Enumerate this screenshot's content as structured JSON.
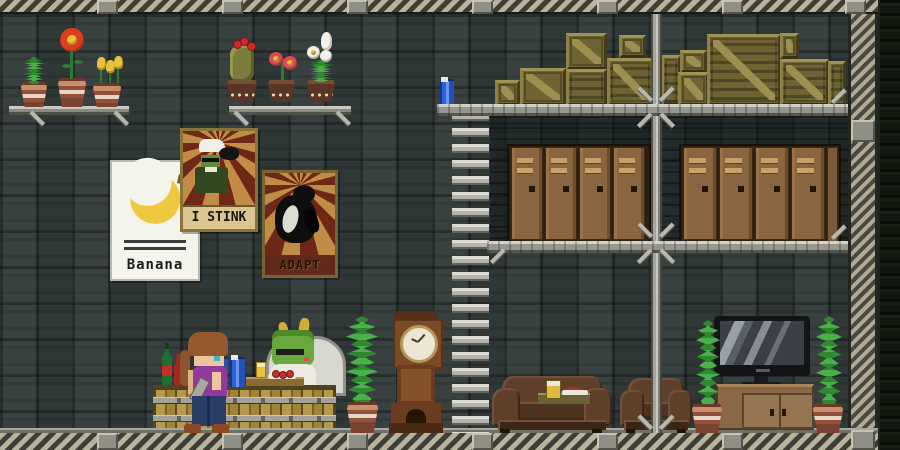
{
  "window": {
    "width": 900,
    "height": 450,
    "title": "Pixel-art station interior with bar, storage lockers and cargo crates"
  },
  "posters": {
    "banana": {
      "label": "Banana"
    },
    "stink": {
      "label": "I STINK"
    },
    "adapt": {
      "label": "ADAPT"
    }
  },
  "palette": {
    "wall": "#323a3a",
    "hazard_light": "#b7b39d",
    "hazard_dark": "#3f3e35",
    "platform_gray": "#97978f",
    "crate_khaki": "#6e6433",
    "locker_brown": "#8a6540",
    "couch_brown": "#5d3d28",
    "plant_green": "#3fa03f",
    "pot_terracotta": "#b5704f",
    "counter_wood": "#b59a4e",
    "canister_blue": "#2e62d8",
    "poster_ray_red": "#6f2816",
    "poster_ray_tan": "#c08c46"
  },
  "objects": {
    "ceiling_plates_x": [
      97,
      222,
      347,
      472,
      597,
      722,
      845
    ],
    "floor_plates_x": [
      97,
      222,
      347,
      472,
      597,
      722
    ],
    "brackets": [
      [
        28,
        116,
        45
      ],
      [
        112,
        116,
        45
      ],
      [
        232,
        116,
        45
      ],
      [
        334,
        116,
        45
      ],
      [
        636,
        92,
        45
      ],
      [
        658,
        92,
        -45
      ],
      [
        636,
        118,
        -45
      ],
      [
        658,
        118,
        45
      ],
      [
        830,
        94,
        -45
      ],
      [
        636,
        228,
        45
      ],
      [
        658,
        228,
        -45
      ],
      [
        636,
        254,
        -45
      ],
      [
        658,
        254,
        45
      ],
      [
        830,
        230,
        -45
      ],
      [
        489,
        254,
        -45
      ],
      [
        636,
        420,
        45
      ],
      [
        658,
        420,
        -45
      ]
    ],
    "crates": [
      {
        "x": 495,
        "y": 80,
        "w": 25,
        "h": 26,
        "v": "d"
      },
      {
        "x": 520,
        "y": 68,
        "w": 46,
        "h": 38,
        "v": "d"
      },
      {
        "x": 566,
        "y": 33,
        "w": 41,
        "h": 37,
        "v": "d"
      },
      {
        "x": 566,
        "y": 69,
        "w": 41,
        "h": 37,
        "v": "s"
      },
      {
        "x": 607,
        "y": 58,
        "w": 47,
        "h": 48,
        "v": "ds"
      },
      {
        "x": 619,
        "y": 35,
        "w": 27,
        "h": 23,
        "v": "d"
      },
      {
        "x": 661,
        "y": 55,
        "w": 20,
        "h": 51,
        "v": "s"
      },
      {
        "x": 680,
        "y": 50,
        "w": 27,
        "h": 23,
        "v": "d"
      },
      {
        "x": 678,
        "y": 72,
        "w": 31,
        "h": 34,
        "v": "d"
      },
      {
        "x": 707,
        "y": 34,
        "w": 74,
        "h": 72,
        "v": "ds"
      },
      {
        "x": 780,
        "y": 33,
        "w": 19,
        "h": 26,
        "v": "d"
      },
      {
        "x": 780,
        "y": 59,
        "w": 49,
        "h": 47,
        "v": "ds"
      },
      {
        "x": 828,
        "y": 61,
        "w": 18,
        "h": 45,
        "v": "s"
      }
    ],
    "locker_banks": [
      {
        "x": 507,
        "y": 144,
        "h": 99,
        "doors": 4,
        "door_w": 34,
        "sliver": false
      },
      {
        "x": 679,
        "y": 144,
        "h": 99,
        "doors": 4,
        "door_w": 36,
        "sliver": true
      }
    ],
    "shelf_plants": [
      {
        "type": "sprout",
        "pot_style": "striped",
        "pot": [
          21,
          82,
          26,
          25
        ]
      },
      {
        "type": "flower_red",
        "pot_style": "striped",
        "pot": [
          58,
          78,
          28,
          29
        ]
      },
      {
        "type": "tulip_yellow",
        "pot_style": "striped",
        "pot": [
          93,
          83,
          28,
          24
        ]
      },
      {
        "type": "cactus",
        "pot_style": "dark",
        "pot": [
          227,
          80,
          30,
          22
        ]
      },
      {
        "type": "flower_pink",
        "pot_style": "dark",
        "pot": [
          268,
          80,
          27,
          22
        ]
      },
      {
        "type": "lily",
        "pot_style": "dark",
        "pot": [
          307,
          80,
          28,
          22
        ]
      }
    ],
    "floor_plants": [
      {
        "vine": [
          346,
          316,
          32,
          90
        ],
        "pot": [
          347,
          402,
          31,
          31
        ]
      },
      {
        "vine": [
          696,
          320,
          24,
          88
        ],
        "pot": [
          692,
          404,
          30,
          29
        ]
      },
      {
        "vine": [
          816,
          316,
          26,
          92
        ],
        "pot": [
          813,
          404,
          30,
          29
        ]
      }
    ]
  }
}
